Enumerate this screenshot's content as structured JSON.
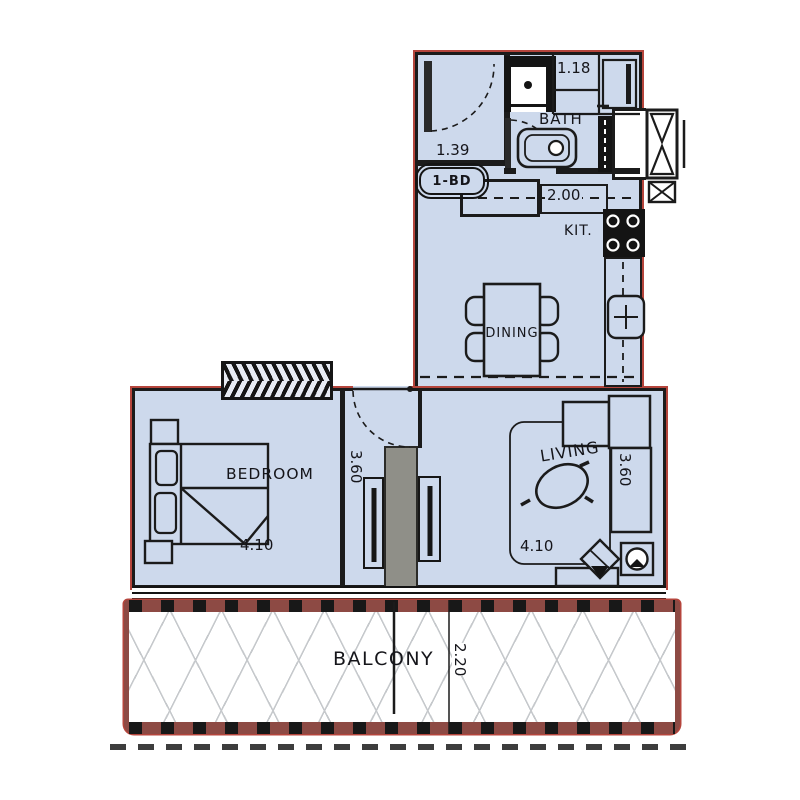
{
  "plan": {
    "unit_type_label": "1-BD",
    "labels": {
      "bath": "BATH",
      "kitchen": "KIT.",
      "dining": "DINING",
      "living": "LIVING",
      "bedroom": "BEDROOM",
      "balcony": "BALCONY"
    },
    "dims": {
      "entry_width": "1.39",
      "bath_width": "1.18",
      "closet_width": "2.00",
      "bedroom_width": "4.10",
      "bedroom_depth": "3.60",
      "living_width": "4.10",
      "living_depth": "3.60",
      "balcony_depth": "2.20"
    },
    "colors": {
      "floor": "#cdd9ec",
      "wall": "#1b1b1b",
      "boundary_red": "#b5453c",
      "balcony_band": "#8d4a44",
      "partition_gray": "#8f8f88",
      "hatch_gray": "#c6c9cc"
    }
  }
}
